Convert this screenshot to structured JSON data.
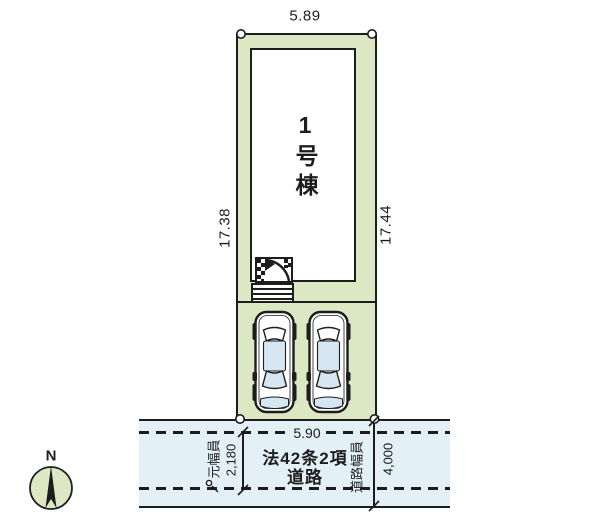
{
  "plan": {
    "building": {
      "label": "1号棟"
    },
    "dimensions": {
      "top_width": "5.89",
      "left_depth": "17.38",
      "right_depth": "17.44",
      "frontage": "5.90",
      "original_road_width": "2,180",
      "road_width": "4,000"
    },
    "road": {
      "type_line1": "法42条2項",
      "type_line2": "道路",
      "original_width_label": "元幅員",
      "width_label": "道路幅員"
    },
    "compass": {
      "north": "N"
    },
    "icons": {
      "car": "car-top-view",
      "entrance": "entrance-porch-steps",
      "compass": "north-compass",
      "survey_point": "boundary-survey-point"
    },
    "colors": {
      "plot_fill": "#dce8c3",
      "road_fill": "#e4f0f8",
      "glass_tint": "#d6e6f2",
      "line": "#1d1d1d"
    }
  }
}
